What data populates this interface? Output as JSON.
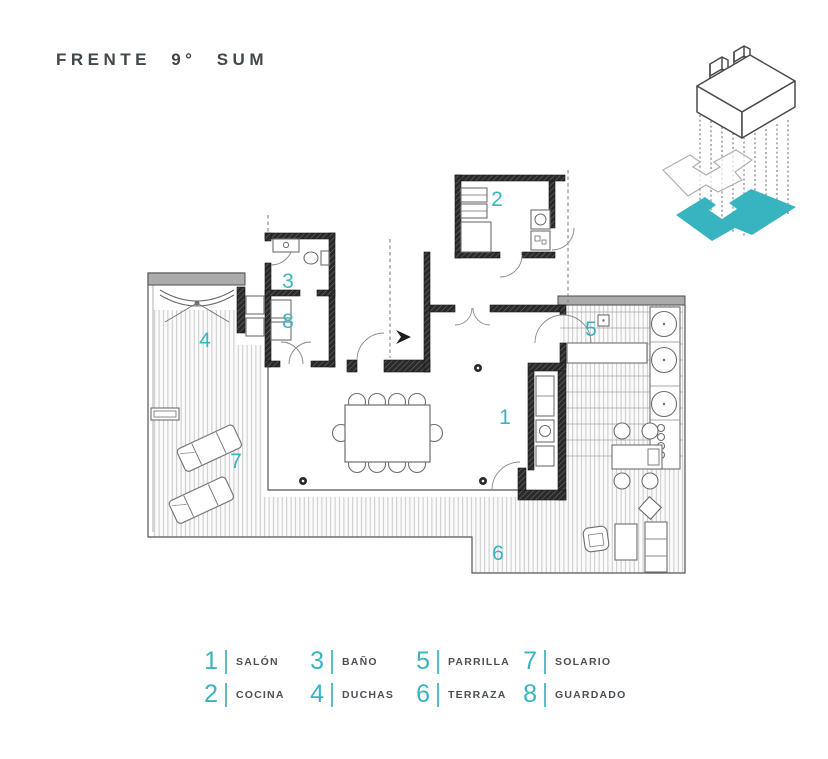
{
  "title": "FRENTE 9° SUM",
  "colors": {
    "accent": "#38b4c1"
  },
  "rooms": [
    {
      "num": "1",
      "label": "SALÓN"
    },
    {
      "num": "2",
      "label": "COCINA"
    },
    {
      "num": "3",
      "label": "BAÑO"
    },
    {
      "num": "4",
      "label": "DUCHAS"
    },
    {
      "num": "5",
      "label": "PARRILLA"
    },
    {
      "num": "6",
      "label": "TERRAZA"
    },
    {
      "num": "7",
      "label": "SOLARIO"
    },
    {
      "num": "8",
      "label": "GUARDADO"
    }
  ]
}
